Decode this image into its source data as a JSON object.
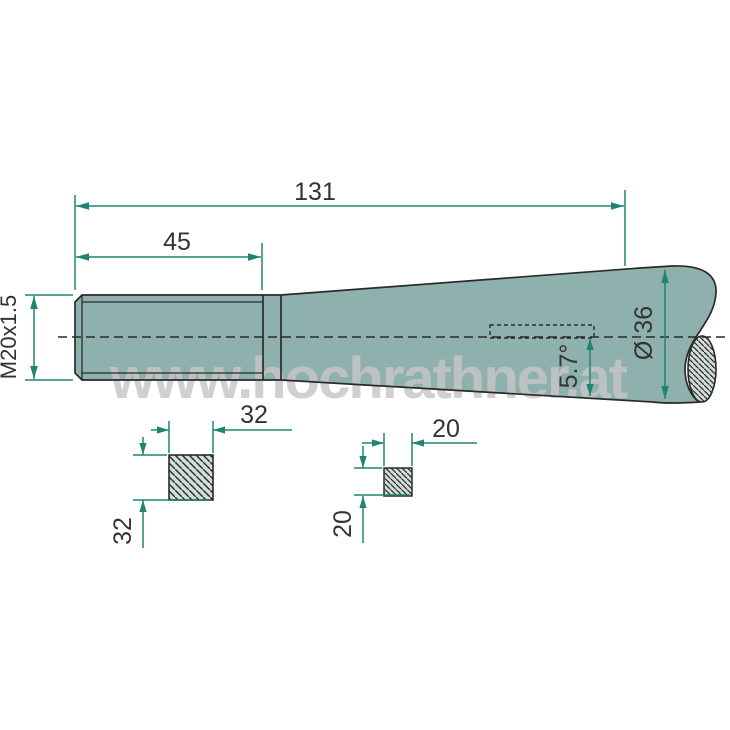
{
  "drawing": {
    "watermark_text": "www.hochrathner.at",
    "dims": {
      "overall_length": "131",
      "thread_length": "45",
      "thread_designation": "M20x1.5",
      "shaft_diameter": "Ø 36",
      "taper_angle": "5.7°",
      "large_section_width": "32",
      "large_section_height": "32",
      "small_section_width": "20",
      "small_section_height": "20"
    },
    "colors": {
      "background": "#FFFFFF",
      "body_fill": "#8FB1AE",
      "section_fill": "#D2DCD8",
      "outline": "#2A2A2A",
      "dimension_line": "#1F8570",
      "dimension_text": "#333333",
      "watermark": "#C6C6C6"
    }
  }
}
